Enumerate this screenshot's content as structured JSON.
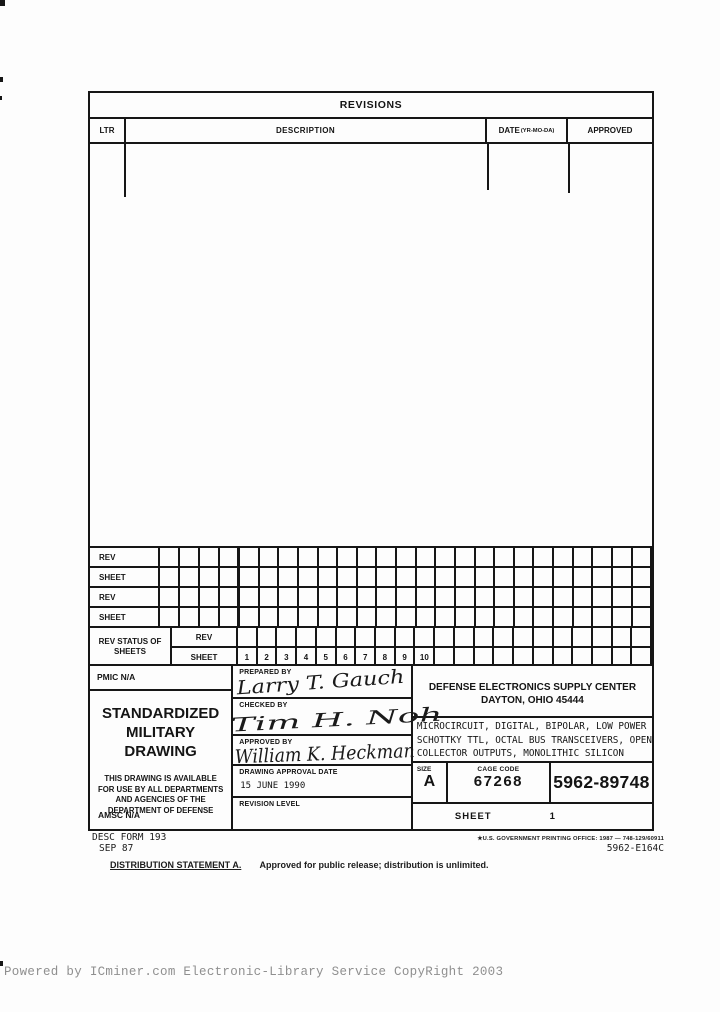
{
  "revisions": {
    "title": "REVISIONS",
    "col_ltr": "LTR",
    "col_description": "DESCRIPTION",
    "col_date": "DATE",
    "col_date_sub": "(YR-MO-DA)",
    "col_approved": "APPROVED"
  },
  "rev_grid": {
    "row_labels": [
      "REV",
      "SHEET",
      "REV",
      "SHEET"
    ],
    "status_label": "REV STATUS OF SHEETS",
    "status_row_rev": "REV",
    "status_row_sheet": "SHEET",
    "sheet_numbers": [
      "1",
      "2",
      "3",
      "4",
      "5",
      "6",
      "7",
      "8",
      "9",
      "10"
    ]
  },
  "title_block": {
    "pmic": "PMIC N/A",
    "smd_title": "STANDARDIZED MILITARY DRAWING",
    "availability": "THIS DRAWING IS AVAILABLE FOR USE BY ALL DEPARTMENTS AND AGENCIES OF THE DEPARTMENT OF DEFENSE",
    "amsc": "AMSC N/A",
    "prepared_label": "PREPARED BY",
    "prepared_signature": "Larry T. Gauch",
    "checked_label": "CHECKED BY",
    "checked_signature": "Tim H. Noh",
    "approved_label": "APPROVED BY",
    "approved_signature": "William K. Heckman",
    "date_label": "DRAWING APPROVAL DATE",
    "date_value": "15 JUNE 1990",
    "revision_level_label": "REVISION LEVEL",
    "agency_line1": "DEFENSE ELECTRONICS SUPPLY CENTER",
    "agency_line2": "DAYTON, OHIO 45444",
    "description_line1": "MICROCIRCUIT, DIGITAL, BIPOLAR, LOW POWER",
    "description_line2": "SCHOTTKY TTL, OCTAL BUS TRANSCEIVERS, OPEN",
    "description_line3": "COLLECTOR OUTPUTS, MONOLITHIC SILICON",
    "size_label": "SIZE",
    "size_value": "A",
    "cage_label": "CAGE CODE",
    "cage_value": "67268",
    "drawing_number": "5962-89748",
    "sheet_label": "SHEET",
    "sheet_value": "1"
  },
  "form_footer": {
    "form_number": "DESC FORM 193",
    "form_date": "SEP 87",
    "printing_office": "★U.S. GOVERNMENT PRINTING OFFICE: 1987 — 748-129/60911",
    "document_code": "5962-E164C",
    "distribution_label": "DISTRIBUTION STATEMENT A.",
    "distribution_text": "Approved for public release; distribution is unlimited."
  },
  "watermark": "Powered by ICminer.com Electronic-Library Service CopyRight 2003"
}
